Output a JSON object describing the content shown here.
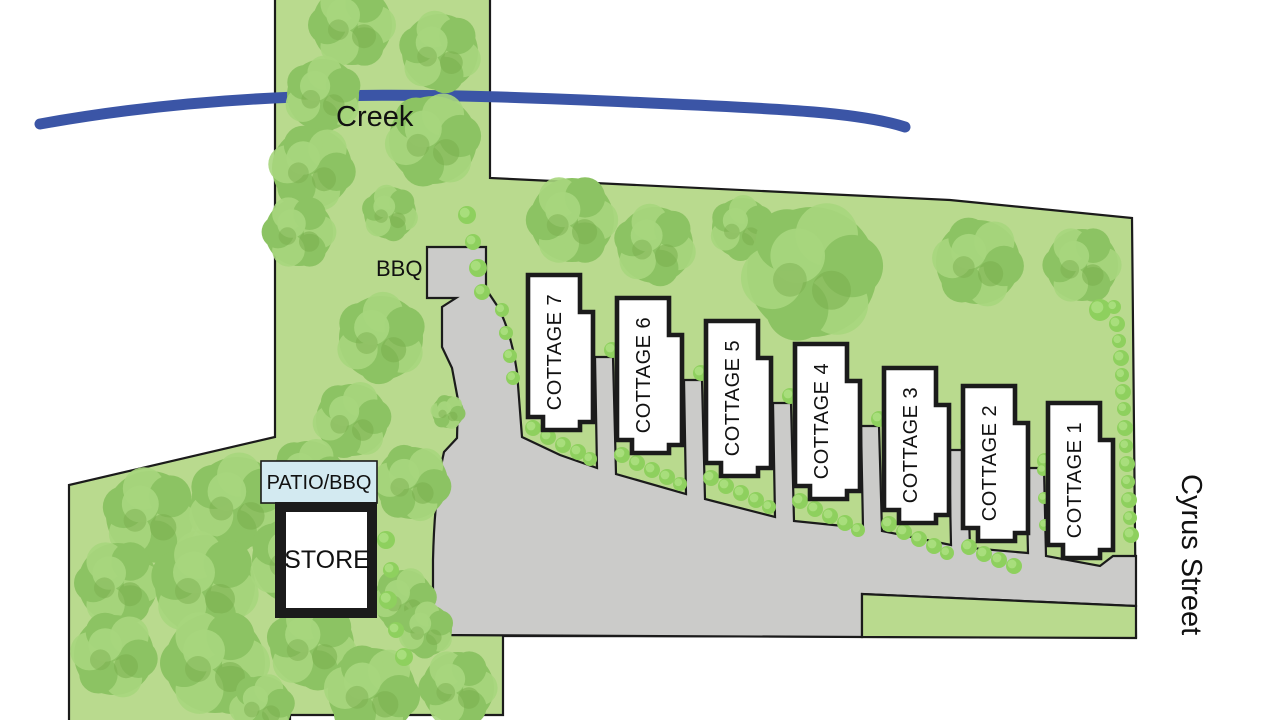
{
  "map": {
    "creek_label": "Creek",
    "bbq_label": "BBQ",
    "patio_label": "PATIO/BBQ",
    "store_label": "STORE",
    "street_label": "Cyrus Street"
  },
  "cottages": [
    {
      "id": 7,
      "label": "COTTAGE 7"
    },
    {
      "id": 6,
      "label": "COTTAGE 6"
    },
    {
      "id": 5,
      "label": "COTTAGE 5"
    },
    {
      "id": 4,
      "label": "COTTAGE 4"
    },
    {
      "id": 3,
      "label": "COTTAGE 3"
    },
    {
      "id": 2,
      "label": "COTTAGE 2"
    },
    {
      "id": 1,
      "label": "COTTAGE 1"
    }
  ],
  "colors": {
    "ground": "#b9da8e",
    "tree_base": "#8cc363",
    "tree_light": "#a7d67d",
    "tree_dark": "#7aae4e",
    "bush": "#8ed05e",
    "bush_light": "#abdf80",
    "driveway": "#cbcbc9",
    "creek": "#3b55a6",
    "patio": "#d3eaf1",
    "outline": "#1b1b1b",
    "building_fill": "#ffffff",
    "text": "#111111"
  }
}
